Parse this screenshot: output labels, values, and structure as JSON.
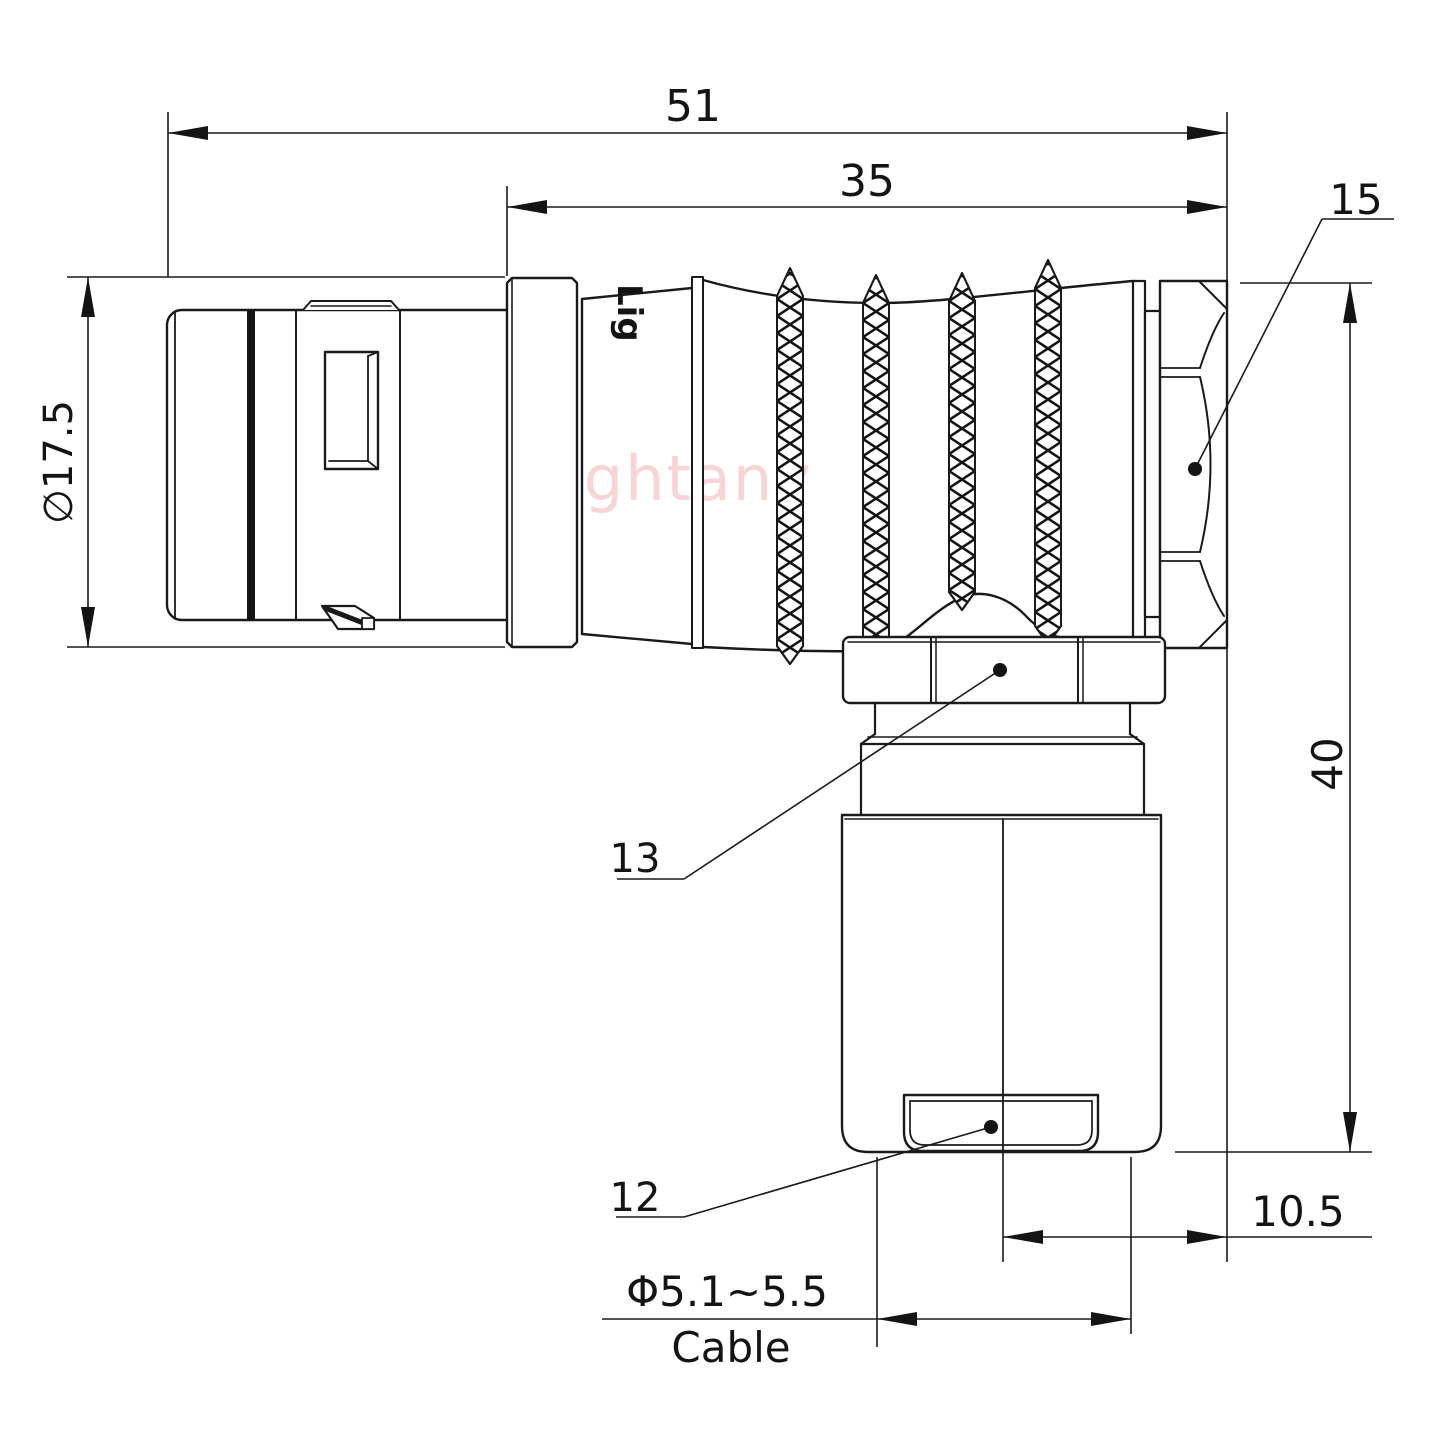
{
  "drawing": {
    "watermark": "Lightany",
    "body_marking": "Lig",
    "line_color": "#1a1a1a",
    "watermark_color": "#f6cbcb",
    "dimensions": {
      "overall_length": "51",
      "barrel_length": "35",
      "nut_width": "15",
      "plug_diameter": "∅17.5",
      "overall_height": "40",
      "axis_offset": "10.5",
      "cable_diameter": "Φ5.1~5.5",
      "cable_word": "Cable",
      "ref_gland_nut": "13",
      "ref_bushing": "12"
    }
  }
}
